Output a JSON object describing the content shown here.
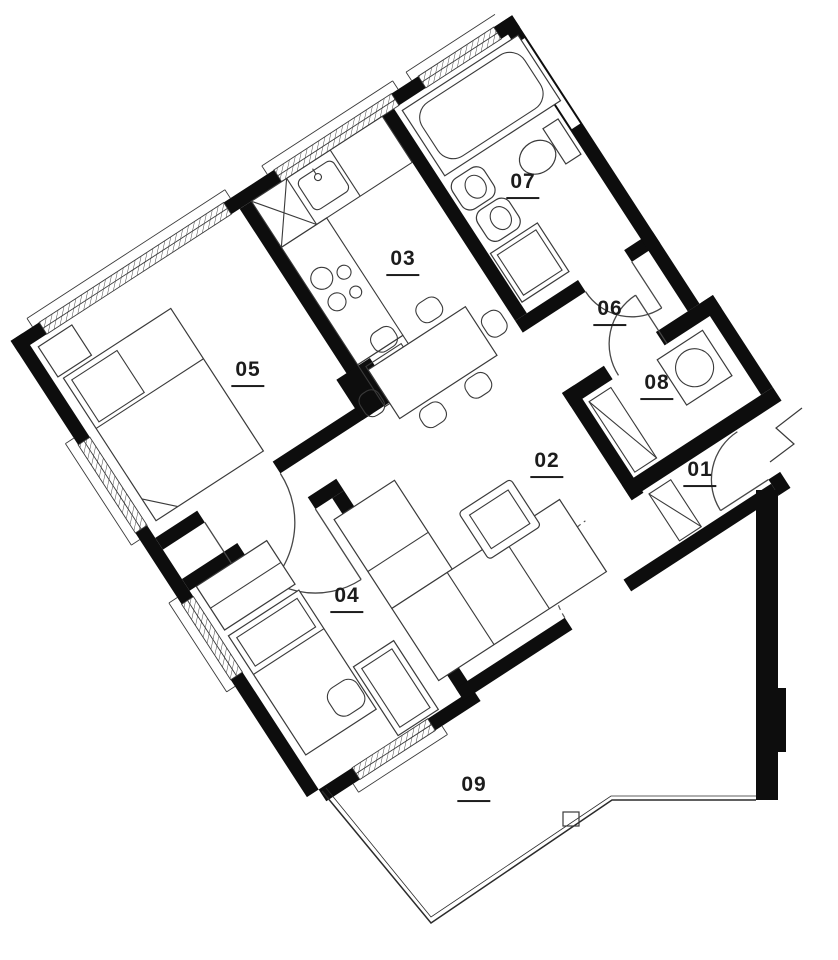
{
  "plan": {
    "rooms": [
      {
        "label": "01"
      },
      {
        "label": "02"
      },
      {
        "label": "03"
      },
      {
        "label": "04"
      },
      {
        "label": "05"
      },
      {
        "label": "06"
      },
      {
        "label": "07"
      },
      {
        "label": "08"
      },
      {
        "label": "09"
      }
    ]
  },
  "colors": {
    "wall": "#0d0d0d",
    "line": "#3a3a3a",
    "label": "#1c1c1c",
    "background": "#ffffff"
  }
}
